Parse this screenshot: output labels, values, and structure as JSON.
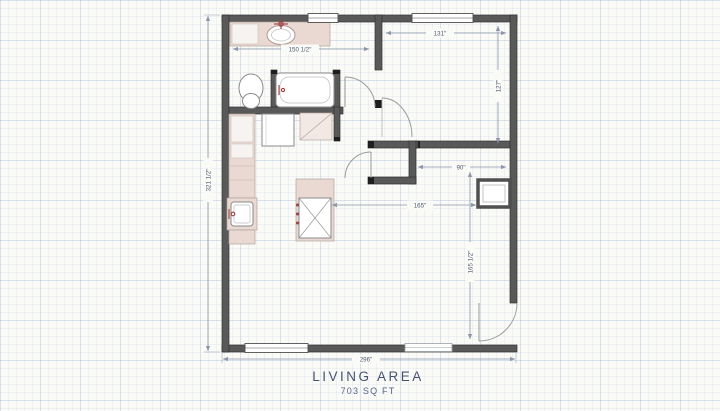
{
  "title": {
    "label": "LIVING AREA",
    "area": "703 SQ FT"
  },
  "dimensions": {
    "bathroom_width": "150 1/2\"",
    "bedroom_width": "131\"",
    "bedroom_depth": "127\"",
    "hallway_width": "90\"",
    "living_width": "165\"",
    "living_depth": "165 1/2\"",
    "overall_width": "296\"",
    "overall_height": "321 1/2\""
  },
  "colors": {
    "paper": "#fafaf7",
    "grid": "#cdd6e4",
    "wall": "#595959",
    "counter": "#ead9d2",
    "fixture_accent": "#9c4040",
    "dimension": "#8d96aa",
    "title_text": "#46536f"
  }
}
